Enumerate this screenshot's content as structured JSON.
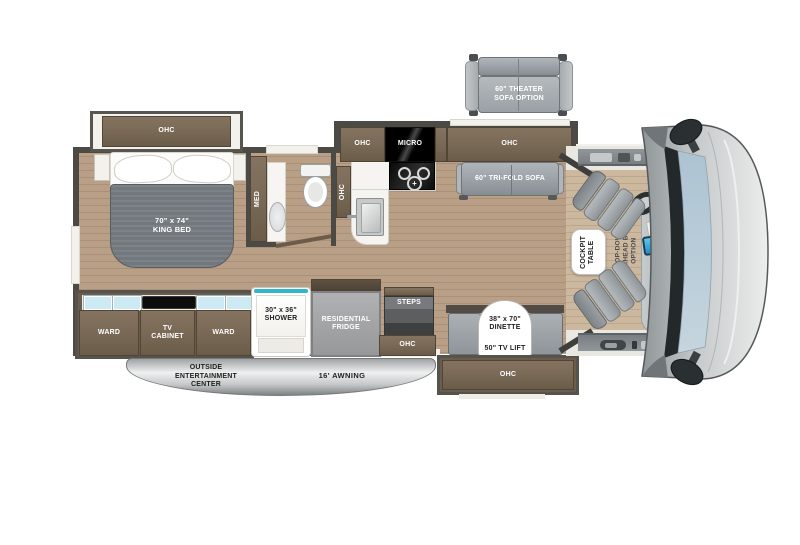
{
  "plan": {
    "bedroom": {
      "ohc_slide": "OHC",
      "king_bed": "70\" x 74\"\nKING BED"
    },
    "bathroom": {
      "med_cabinet": "MED",
      "ohc_cabinet": "OHC"
    },
    "kitchen": {
      "ohc_cabinet": "OHC",
      "microwave": "MICRO",
      "ohc_long": "OHC"
    },
    "living": {
      "tri_fold_sofa": "60\" TRI-FOLD SOFA",
      "theater_sofa_option": "60\" THEATER\nSOFA OPTION"
    },
    "wardrobe_slide": {
      "ward_left": "WARD",
      "tv_cabinet": "TV\nCABINET",
      "ward_right": "WARD"
    },
    "shower": {
      "label": "30\" x 36\"\nSHOWER"
    },
    "fridge": {
      "label": "RESIDENTIAL\nFRIDGE"
    },
    "entry": {
      "steps": "STEPS",
      "ohc": "OHC"
    },
    "dinette": {
      "size": "38\" x 70\"\nDINETTE",
      "tv_lift": "50\" TV LIFT",
      "ohc_slide": "OHC"
    },
    "cockpit": {
      "table": "COCKPIT\nTABLE",
      "bunk_option": "DROP-DOWN\nOVERHEAD BUNK\nOPTION"
    },
    "exterior": {
      "entertainment": "OUTSIDE\nENTERTAINMENT\nCENTER",
      "awning": "16' AWNING"
    }
  },
  "colors": {
    "floor": "#b79d83",
    "cabinet_wood": "#7a6a57",
    "wall": "#4c4a45",
    "upholstery": "#9aa0a5",
    "shower_accent": "#2fb6c9",
    "windshield_glass": "#b6c9d6",
    "awning_gray": "#c7c9ca"
  }
}
